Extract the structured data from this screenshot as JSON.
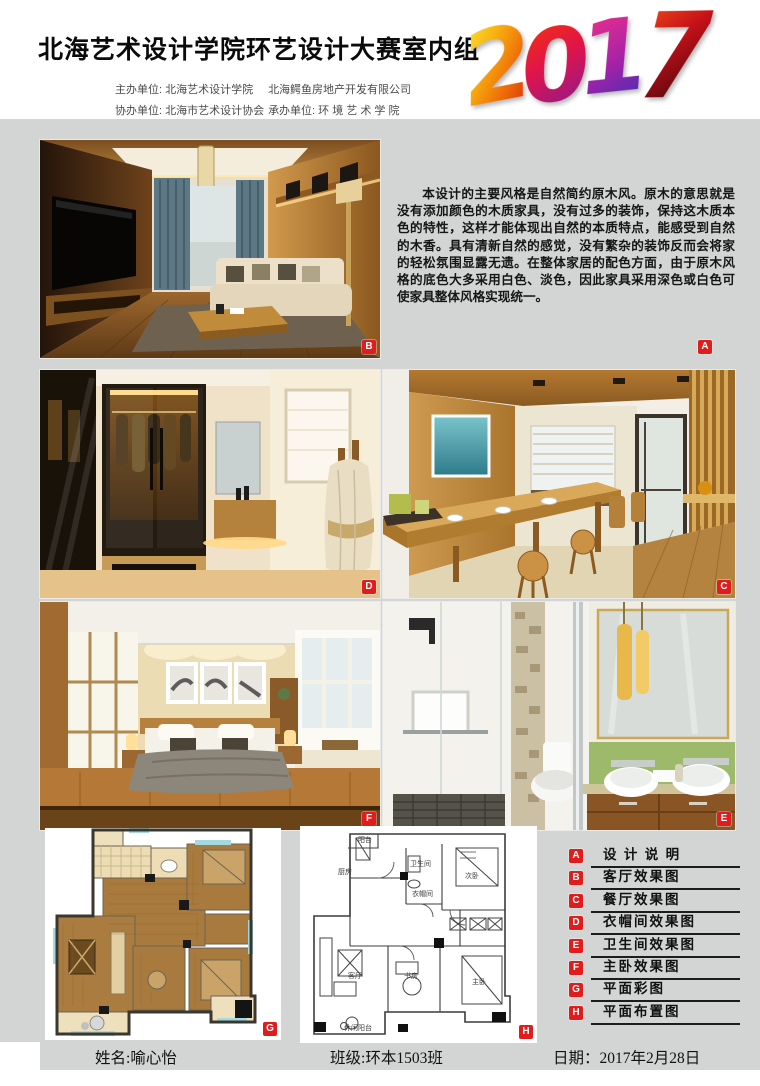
{
  "page": {
    "background": "#d3d4d4",
    "accent_red": "#e11c1c"
  },
  "header": {
    "title": "北海艺术设计学院环艺设计大赛室内组",
    "organizer_rows": [
      {
        "col1": "主办单位: 北海艺术设计学院",
        "col2": "北海鳄鱼房地产开发有限公司"
      },
      {
        "col1": "协办单位: 北海市艺术设计协会",
        "col2": "承办单位: 环 境 艺 术 学 院"
      }
    ],
    "year": "2017",
    "year_chars": [
      "2",
      "0",
      "1",
      "7"
    ]
  },
  "description": {
    "tag": "A",
    "text": "本设计的主要风格是自然简约原木风。原木的意思就是没有添加颜色的木质家具，没有过多的装饰，保持这木质本色的特性，这样才能体现出自然的本质特点，能感受到自然的木香。具有清新自然的感觉，没有繁杂的装饰反而会将家的轻松氛围显露无遗。在整体家居的配色方面，由于原木风格的底色大多采用白色、淡色，因此家具采用深色或白色可使家具整体风格实现统一。"
  },
  "panels": {
    "living": {
      "tag": "B"
    },
    "dining": {
      "tag": "C"
    },
    "closet": {
      "tag": "D"
    },
    "bath": {
      "tag": "E"
    },
    "bedroom": {
      "tag": "F"
    },
    "plan_color": {
      "tag": "G"
    },
    "plan_layout": {
      "tag": "H"
    }
  },
  "plan_labels": {
    "balcony": "阳台",
    "kitchen": "厨房",
    "bathroom": "卫生间",
    "bedroom2": "次卧",
    "closet": "衣帽间",
    "living": "客厅",
    "study": "书房",
    "master": "主卧",
    "leisure_balcony": "休闲阳台"
  },
  "legend": {
    "items": [
      {
        "tag": "A",
        "label": "设 计 说 明"
      },
      {
        "tag": "B",
        "label": "客厅效果图"
      },
      {
        "tag": "C",
        "label": "餐厅效果图"
      },
      {
        "tag": "D",
        "label": "衣帽间效果图"
      },
      {
        "tag": "E",
        "label": "卫生间效果图"
      },
      {
        "tag": "F",
        "label": "主卧效果图"
      },
      {
        "tag": "G",
        "label": "平面彩图"
      },
      {
        "tag": "H",
        "label": "平面布置图"
      }
    ]
  },
  "footer": {
    "name_label": "姓名:",
    "name": "喻心怡",
    "class_label": "班级:",
    "class_value": "环本1503班",
    "date_label": "日期：",
    "date": "2017年2月28日"
  }
}
